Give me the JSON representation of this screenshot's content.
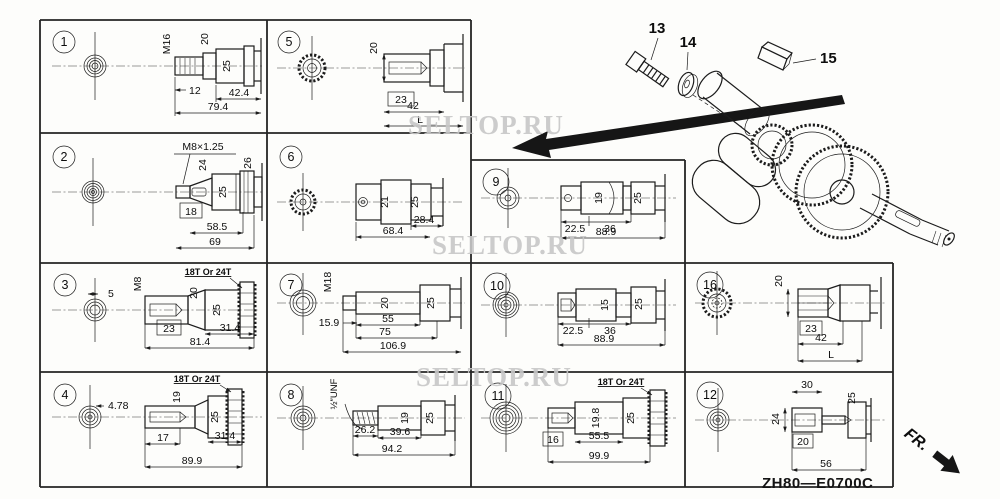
{
  "watermark": {
    "text": "SELTOP.RU"
  },
  "footer": {
    "drawing_code": "ZH80—E0700C",
    "front_label": "FR."
  },
  "parts": {
    "bolt_label": "13",
    "washer_label": "14",
    "key_label": "15"
  },
  "cells": {
    "c1": {
      "num": "1",
      "thread": "M16",
      "d1": "20",
      "d2": "25",
      "l1": "12",
      "l2": "42.4",
      "l3": "79.4"
    },
    "c2": {
      "num": "2",
      "thread": "M8×1.25",
      "d1": "24",
      "d2": "26",
      "d3": "25",
      "l1": "18",
      "l2": "58.5",
      "l3": "69"
    },
    "c3": {
      "num": "3",
      "note": "18T Or 24T",
      "k": "5",
      "thread": "M8",
      "d1": "20",
      "d2": "25",
      "l1": "23",
      "l2": "31.4",
      "l3": "81.4"
    },
    "c4": {
      "num": "4",
      "note": "18T Or 24T",
      "k": "4.78",
      "d1": "19",
      "d2": "25",
      "l1": "17",
      "l2": "31.4",
      "l3": "89.9"
    },
    "c5": {
      "num": "5",
      "d1": "20",
      "l1": "23",
      "l2": "42",
      "l3": "L"
    },
    "c6": {
      "num": "6",
      "d1": "21",
      "d2": "25",
      "l1": "28.4",
      "l2": "68.4"
    },
    "c7": {
      "num": "7",
      "thread": "M18",
      "d1": "20",
      "d2": "25",
      "l1": "15.9",
      "l2": "55",
      "l3": "75",
      "l4": "106.9"
    },
    "c8": {
      "num": "8",
      "thread": "½″UNF",
      "d1": "19",
      "d2": "25",
      "l1": "26.2",
      "l2": "39.6",
      "l3": "94.2"
    },
    "c9": {
      "num": "9",
      "d1": "19",
      "d2": "25",
      "l1": "22.5",
      "l2": "36",
      "l3": "88.9"
    },
    "c10": {
      "num": "10",
      "d1": "15",
      "d2": "25",
      "l1": "22.5",
      "l2": "36",
      "l3": "88.9"
    },
    "c11": {
      "num": "11",
      "note": "18T Or 24T",
      "d1": "19.8",
      "d2": "25",
      "l1": "16",
      "l2": "55.5",
      "l3": "99.9"
    },
    "c16": {
      "num": "16",
      "d1": "20",
      "l1": "23",
      "l2": "42",
      "l3": "L"
    },
    "c12": {
      "num": "12",
      "d1": "30",
      "d2": "25",
      "d3": "24",
      "l1": "20",
      "l2": "56"
    }
  }
}
